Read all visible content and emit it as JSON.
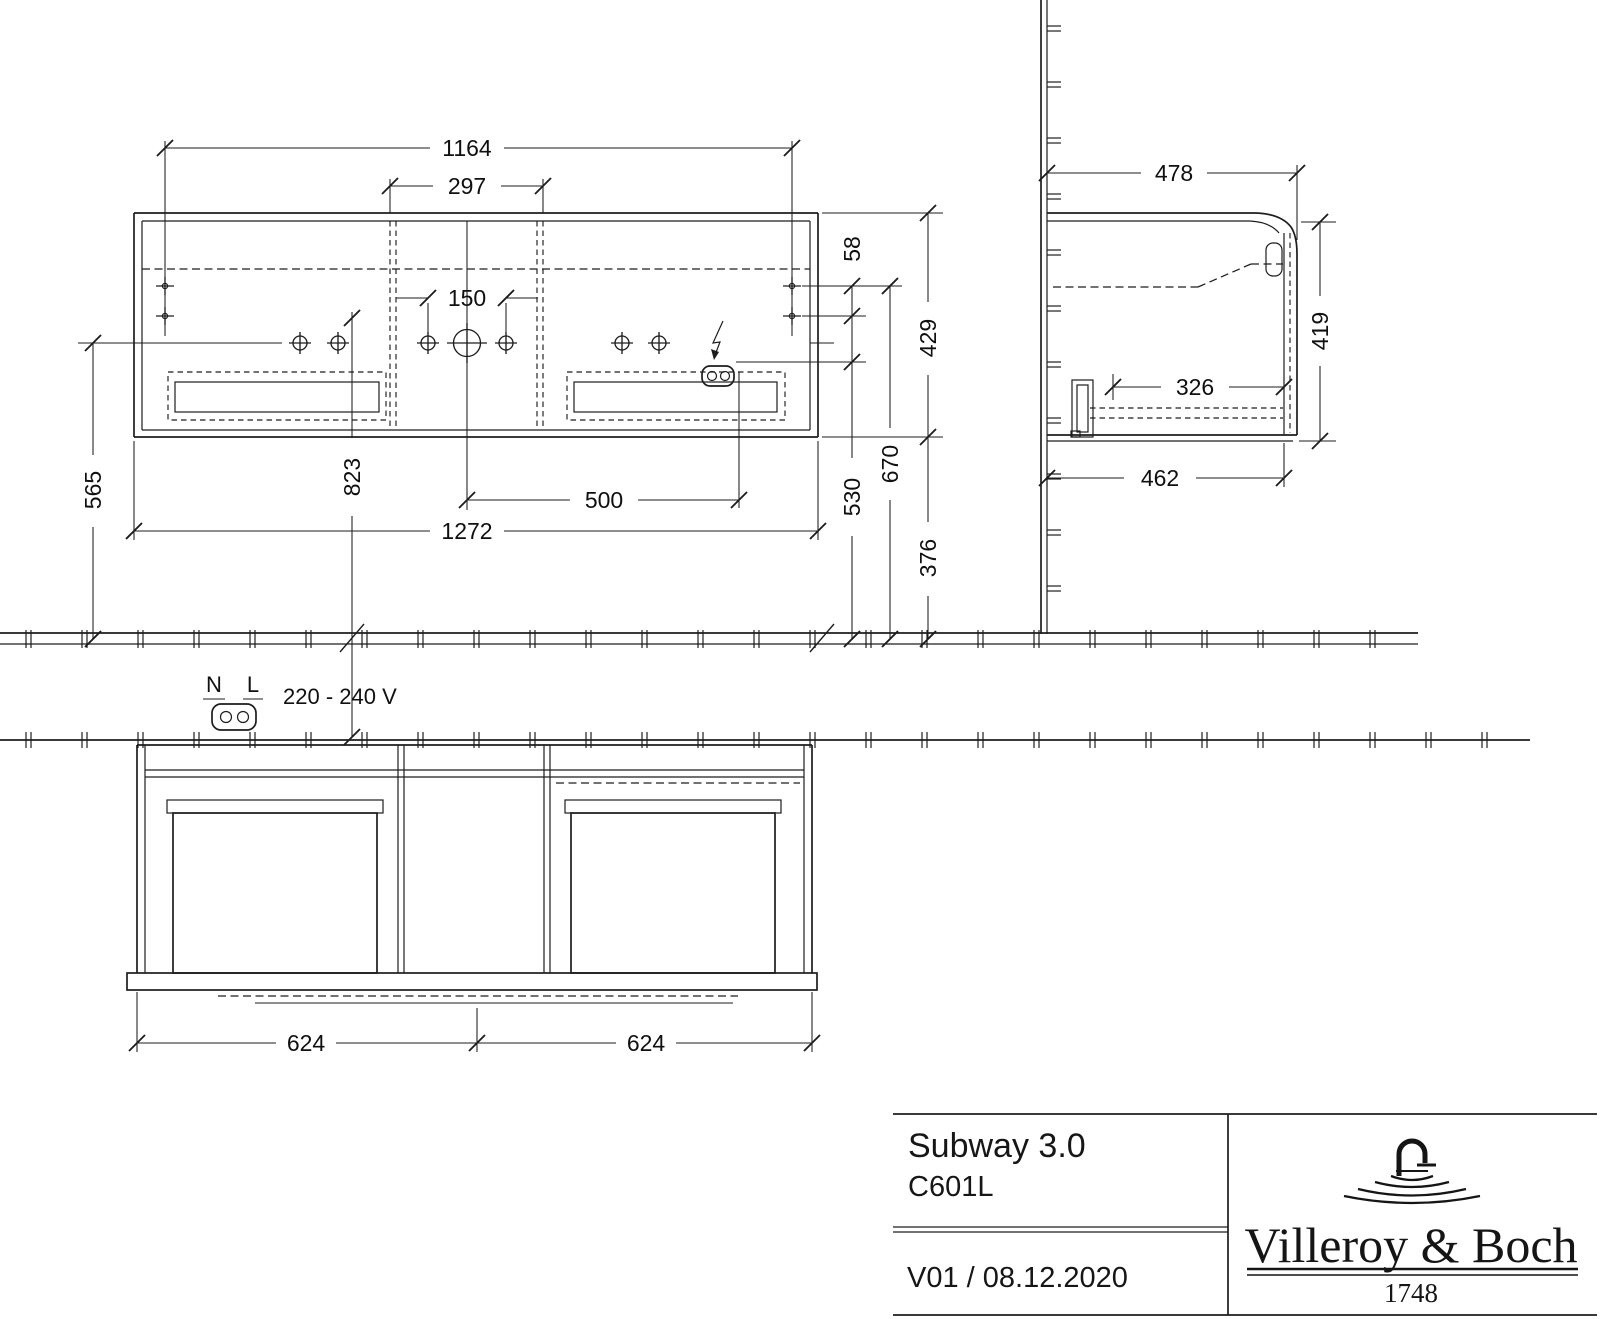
{
  "front_view": {
    "dims": {
      "hole_spacing": "1164",
      "center_section_width": "297",
      "faucet_hole_spacing": "150",
      "socket_offset": "500",
      "total_width": "1272",
      "hanger_to_top": "58",
      "cabinet_height": "429",
      "hanger_height": "670",
      "socket_height": "530",
      "bottom_clearance": "376",
      "hole_row_height": "565",
      "mounting_height": "823"
    }
  },
  "side_view": {
    "dims": {
      "total_depth": "478",
      "height": "419",
      "inner_depth": "326",
      "carcass_depth": "462"
    }
  },
  "bottom_view": {
    "dims": {
      "drawer_widths": [
        "624",
        "624"
      ]
    }
  },
  "electrical": {
    "neutral_label": "N",
    "line_label": "L",
    "voltage": "220 - 240 V"
  },
  "title_block": {
    "series": "Subway 3.0",
    "model": "C601L",
    "version": "V01 / 08.12.2020",
    "brand": "Villeroy & Boch",
    "brand_year": "1748"
  }
}
